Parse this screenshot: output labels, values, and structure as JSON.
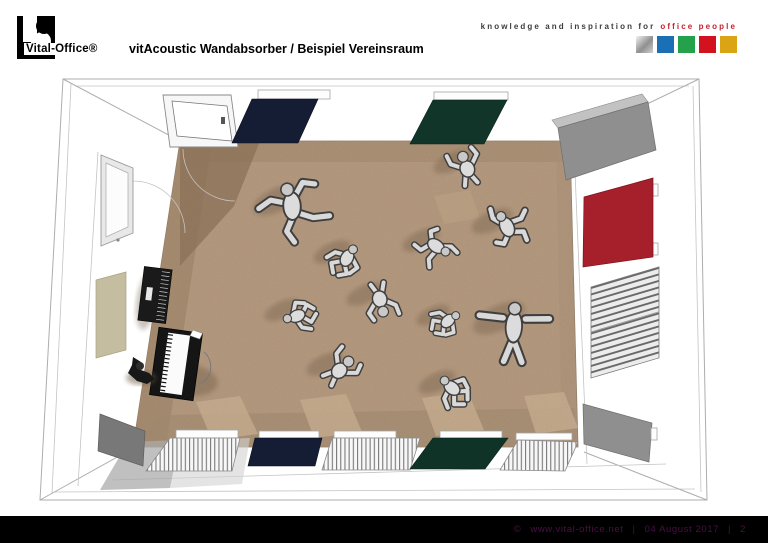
{
  "header": {
    "logo_text": "Vital-Office®",
    "title": "vitAcoustic Wandabsorber / Beispiel Vereinsraum",
    "tagline": {
      "prefix": "knowledge and inspiration for",
      "accent": "office people",
      "accent_color": "#c8202e"
    },
    "brand_squares": [
      {
        "name": "silver",
        "color": "#b9b9b9",
        "gradient": true
      },
      {
        "name": "blue",
        "color": "#1a6fb5"
      },
      {
        "name": "green",
        "color": "#23a14b"
      },
      {
        "name": "red",
        "color": "#d2121f"
      },
      {
        "name": "gold",
        "color": "#dba414"
      }
    ]
  },
  "footer": {
    "copyright": "©",
    "url": "www.vital-office.net",
    "separator": "|",
    "date": "04 August 2017",
    "page": "2",
    "bar_color": "#000000",
    "text_color": "#4b0f45"
  },
  "scene": {
    "description": "Top view 3D rendering of a Vereinsraum (club room): eleven dancing figures on a tan carpet, a pianist at a piano, a media rack, a door, a whiteboard, radiator grills and colored vitAcoustic wall absorber panels",
    "floor_color": "#b59a7f",
    "panel_colors": {
      "navy": "#141d33",
      "dark_green": "#113629",
      "red": "#a6202c",
      "grey": "#8f8f8f",
      "beige": "#c4bda0"
    },
    "figures": [
      {
        "x": 292,
        "y": 206,
        "pose": "spread",
        "rot": -25,
        "s": 1.3
      },
      {
        "x": 347,
        "y": 258,
        "pose": "crouch",
        "rot": 35,
        "s": 1.0
      },
      {
        "x": 436,
        "y": 246,
        "pose": "armup",
        "rot": 115,
        "s": 1.0
      },
      {
        "x": 467,
        "y": 168,
        "pose": "bent",
        "rot": -20,
        "s": 1.0
      },
      {
        "x": 507,
        "y": 227,
        "pose": "armup",
        "rot": -35,
        "s": 1.1
      },
      {
        "x": 297,
        "y": 316,
        "pose": "crouch",
        "rot": -105,
        "s": 0.95
      },
      {
        "x": 380,
        "y": 300,
        "pose": "bent",
        "rot": 165,
        "s": 1.0
      },
      {
        "x": 448,
        "y": 321,
        "pose": "crouch",
        "rot": 55,
        "s": 0.9
      },
      {
        "x": 514,
        "y": 324,
        "pose": "tpose",
        "rot": 3,
        "s": 1.4
      },
      {
        "x": 340,
        "y": 370,
        "pose": "bent",
        "rot": 45,
        "s": 1.0
      },
      {
        "x": 452,
        "y": 388,
        "pose": "crouch",
        "rot": -45,
        "s": 1.0
      }
    ]
  }
}
